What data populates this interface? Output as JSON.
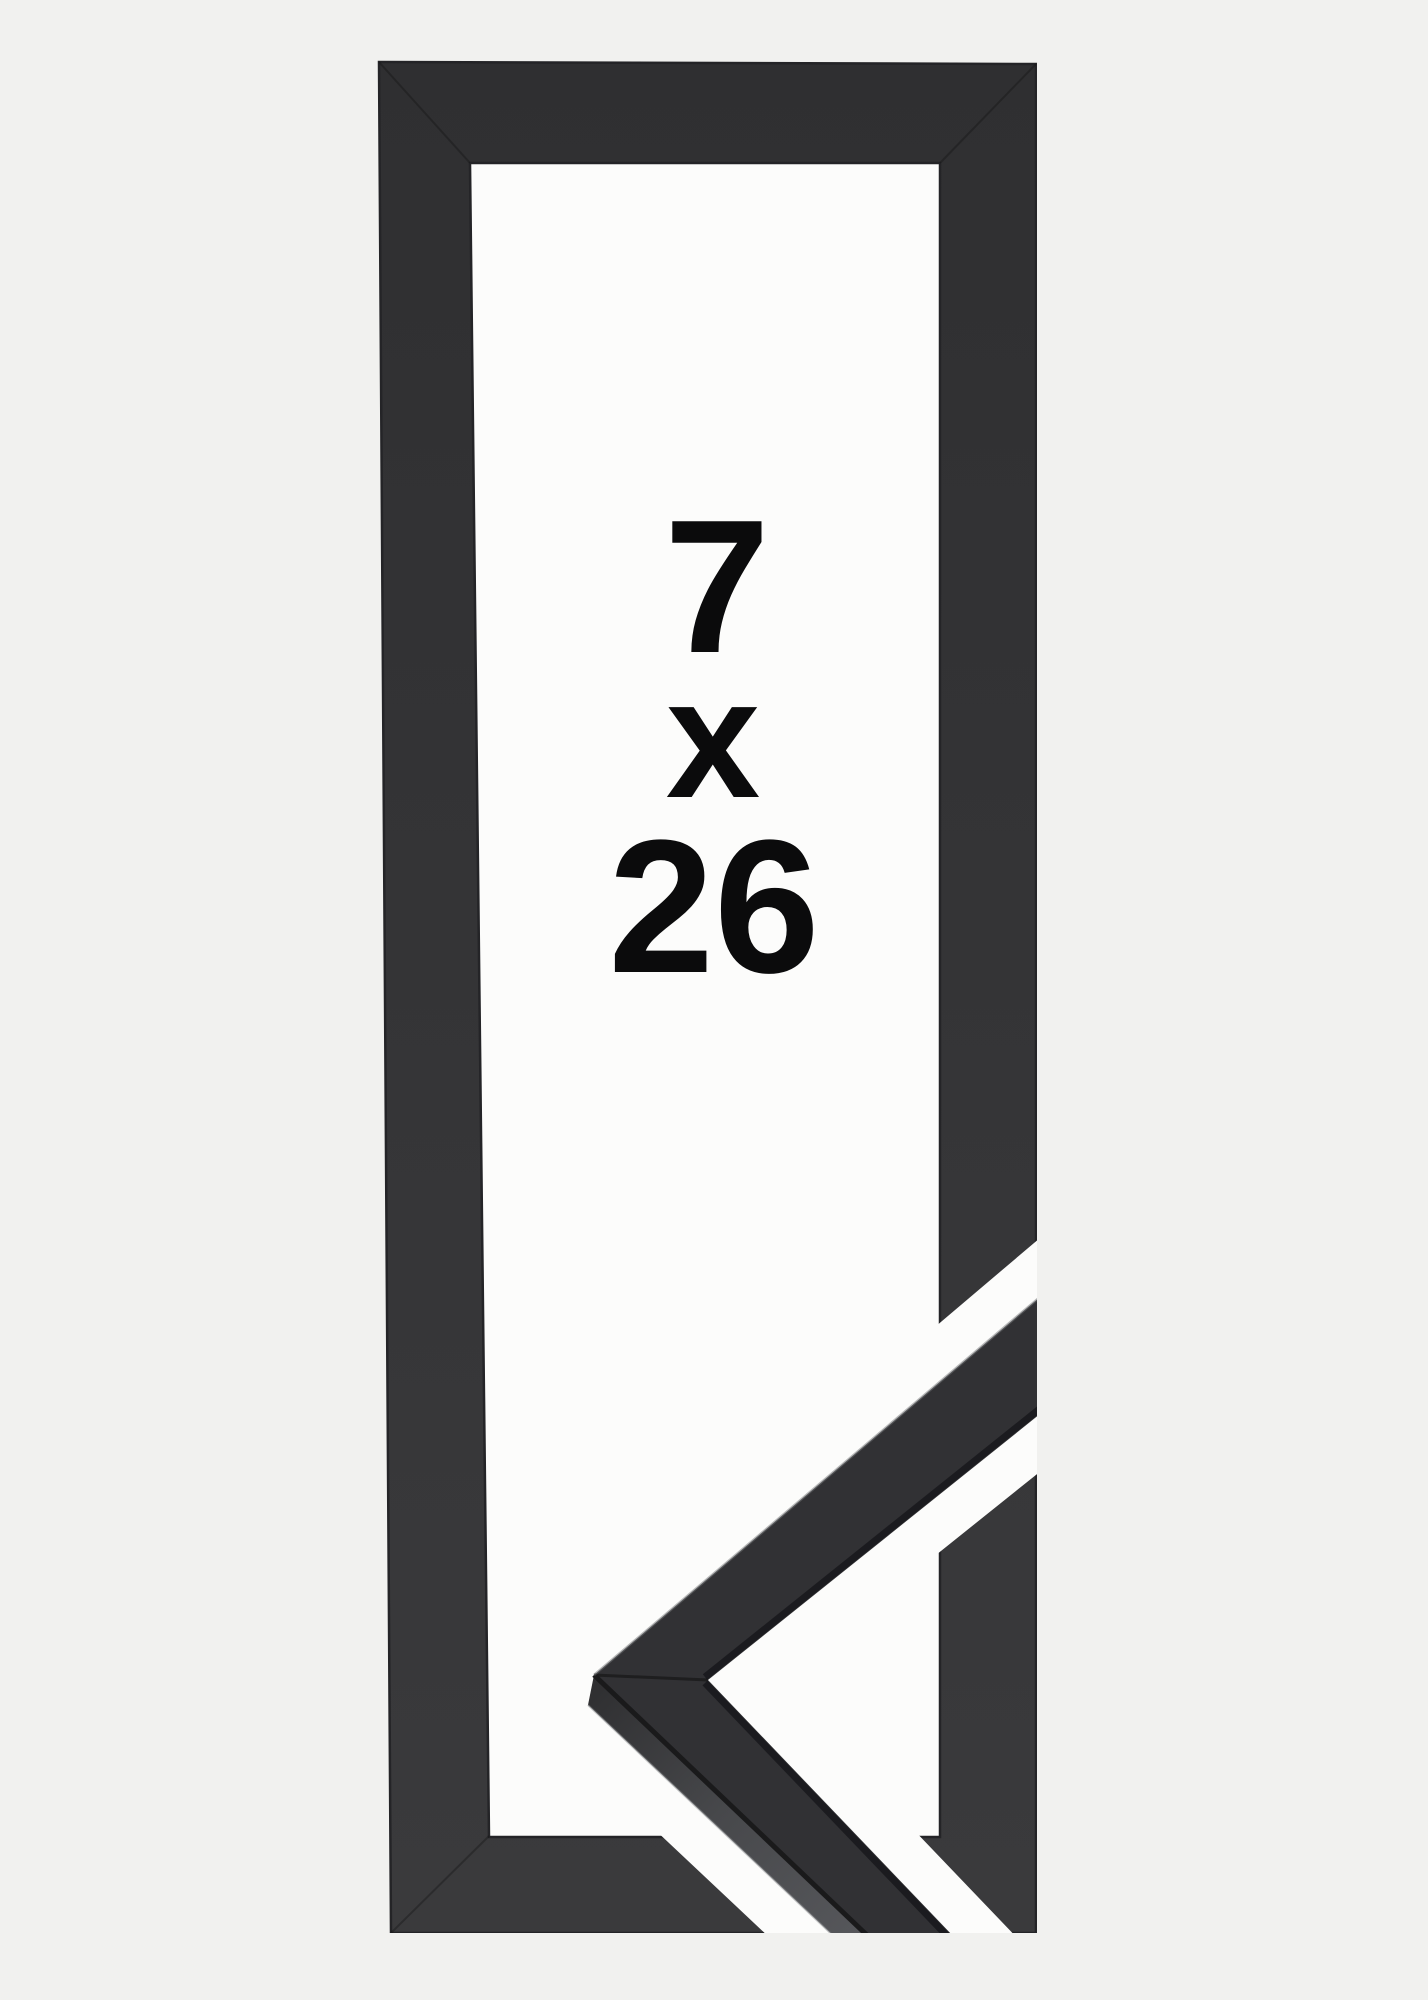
{
  "product_image": {
    "alt": "Black wooden picture frame shown with a mitered corner profile sample overlapping the lower right",
    "size_label": {
      "width": "7",
      "separator": "x",
      "height": "26"
    }
  },
  "colors": {
    "background": "#f1f1ef",
    "mat_white": "#fcfcfb",
    "frame_top": "#2f2f31",
    "frame_bottom": "#3a3a3c",
    "frame_edge": "#242427",
    "sample_front": "#313134",
    "sample_side_dark": "#2e2e30",
    "sample_side_mid": "#47484b",
    "sample_side_light": "#595a5e",
    "text": "#0b0b0c"
  }
}
